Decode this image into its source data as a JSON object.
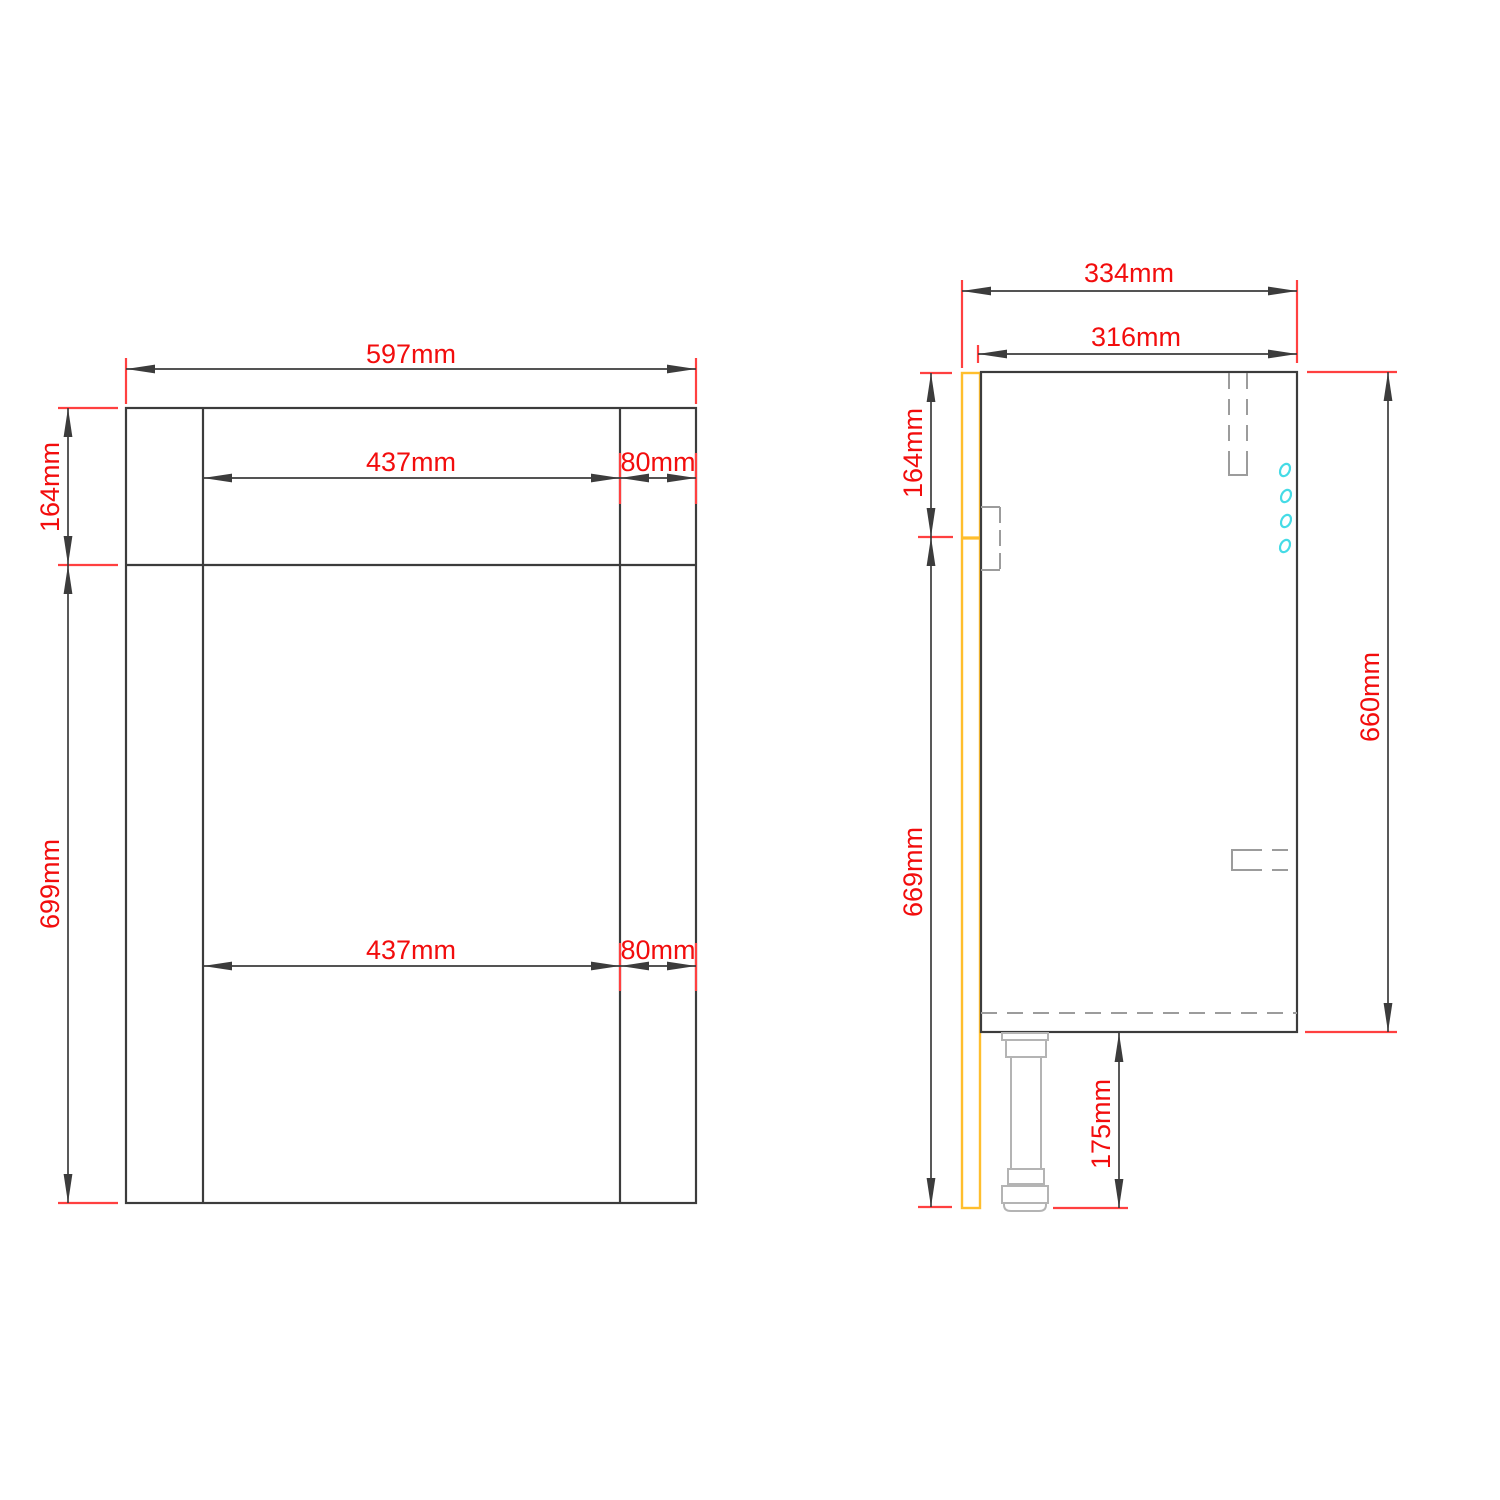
{
  "drawing_title": "bathroom-unit-technical-drawing",
  "colors": {
    "line_dark": "#3c3c3c",
    "dimension_red": "#f20d0d",
    "tick_red": "#ff4040",
    "panel_yellow": "#ffbe2d",
    "hardware_gray": "#9c9c9c",
    "leg_gray": "#b4b4b4",
    "hole_cyan": "#45dbe6"
  },
  "front_view": {
    "width": "597mm",
    "top_height": "164mm",
    "body_height": "699mm",
    "opening_width_top": "437mm",
    "stile_width_top": "80mm",
    "opening_width_bottom": "437mm",
    "stile_width_bottom": "80mm"
  },
  "side_view": {
    "depth_overall": "334mm",
    "depth_body": "316mm",
    "top_height": "164mm",
    "front_panel_height": "669mm",
    "body_height": "660mm",
    "leg_height": "175mm"
  }
}
